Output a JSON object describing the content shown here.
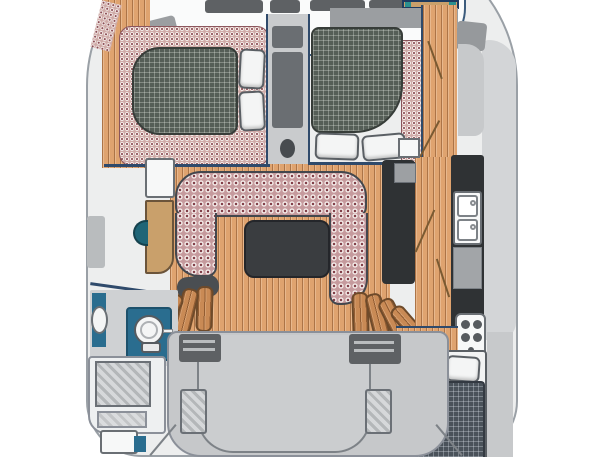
{
  "diagram": {
    "type": "boat-floor-plan",
    "subject": "Catamaran interior layout, top-down plan view, no visible text",
    "visible_text": [],
    "palette": {
      "hull_outline": "#9aa0a6",
      "hull_fill": "#edeeee",
      "wall_line": "#2f4a6b",
      "wood_floor": "#dfa36f",
      "wood_steps": "#c98a55",
      "upholstery_pink": "#c59a9d",
      "upholstery_dot_maroon": "#7e3b44",
      "mattress_green_gray": "#555e57",
      "mattress_blue_gray": "#4a525a",
      "counter_dark": "#2f3234",
      "counter_gray": "#a2a5a8",
      "deck_gray": "#c6c8ca",
      "hatch_dark_gray": "#5e6164",
      "bath_blue": "#2a6d8f",
      "sink_teal": "#1f6577",
      "table_dark": "#3a3d40",
      "cabinet_tan": "#c9a06b",
      "fixture_white": "#f5f6f6"
    },
    "rooms": {
      "foredeck": {
        "title": "Foredeck with deck hatches and anchor locker",
        "deck_hatches": 4
      },
      "cabin_fwd_port": {
        "title": "Forward port cabin - double berth with 2 pillows",
        "pillows": 2
      },
      "cabin_fwd_stbd": {
        "title": "Forward starboard cabin - double berth with 2 pillows",
        "pillows": 2
      },
      "console": {
        "title": "Central forward console with lockers"
      },
      "salon": {
        "title": "Salon - U-shaped settee with dark cocktail table"
      },
      "galley": {
        "title": "Galley - double sink, counters, 4-burner stove",
        "sinks": 2,
        "stove_burners": 4
      },
      "head_port": {
        "title": "Port head - toilet, wash basin, shower stall",
        "toilet": 1,
        "basin": 1
      },
      "cabin_aft_stbd": {
        "title": "Aft starboard cabin - double berth with 2 pillows",
        "pillows": 2
      },
      "cockpit": {
        "title": "Aft deck / cockpit with two engine hatches",
        "engine_hatches": 2
      },
      "steps_port": {
        "title": "Curved companionway steps to port hull"
      },
      "steps_stbd": {
        "title": "Curved companionway steps to starboard hull"
      },
      "fridge": {
        "title": "Refrigerator / cool box"
      },
      "cabinet": {
        "title": "Wood cabinet with teal wash basin"
      }
    }
  }
}
